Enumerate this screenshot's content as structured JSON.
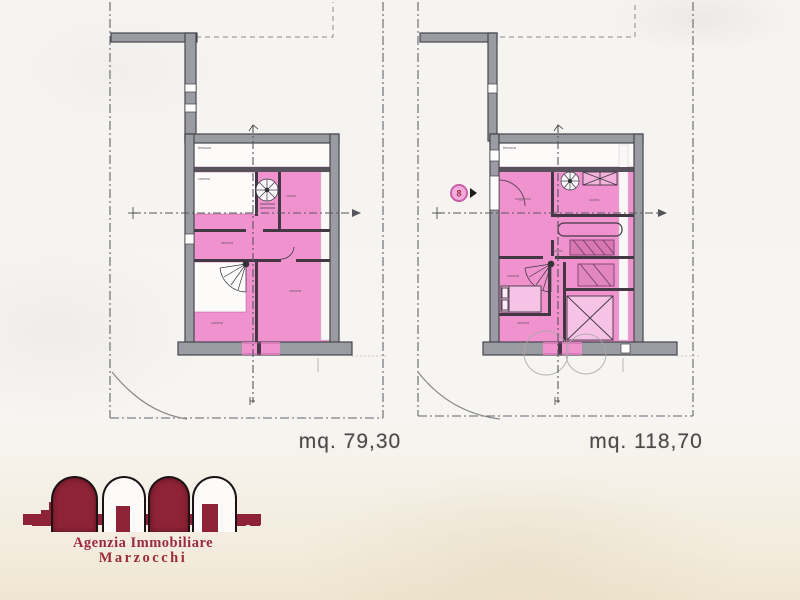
{
  "plans": {
    "left": {
      "area_label": "mq. 79,30",
      "rooms": {
        "strip": "terrazza",
        "room1": "camera",
        "dining": "cucina",
        "hall": "taverna",
        "lower_left": "camera",
        "lower_right": "camera"
      }
    },
    "right": {
      "area_label": "mq. 118,70",
      "marker": "8",
      "rooms": {
        "strip": "terrazza",
        "living": "soggiorno",
        "kitchen": "cucina",
        "bath": "bagno",
        "bedroom1": "camera",
        "bedroom2": "camera"
      }
    }
  },
  "logo": {
    "line1": "Agenzia Immobiliare",
    "line2": "Marzocchi"
  },
  "colors": {
    "room_pink": "#ef92ce",
    "wall_gray": "#9b9ba3",
    "logo_red": "#8e2337",
    "label_gray": "#4a4a4a"
  }
}
